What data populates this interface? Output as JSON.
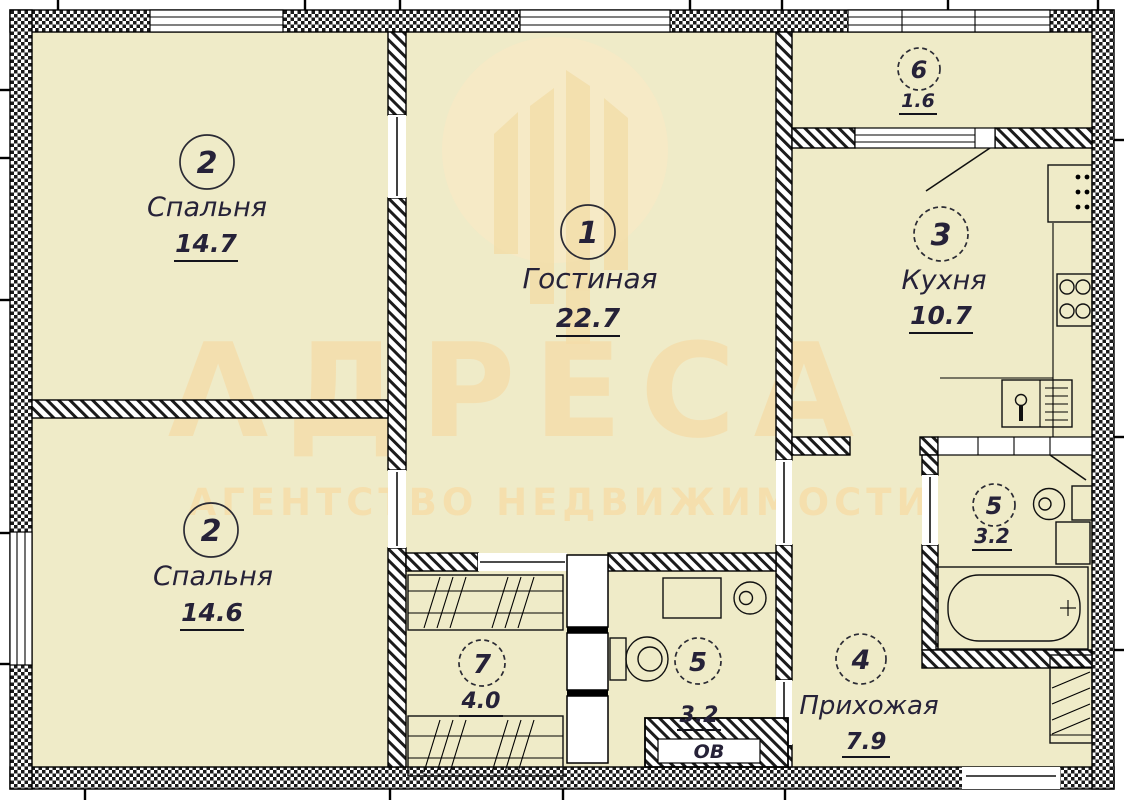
{
  "plan": {
    "watermark": {
      "brand": "АДРЕСА",
      "tagline": "АГЕНТСТВО НЕДВИЖИМОСТИ",
      "logo": "building-in-circle-logo"
    },
    "rooms": {
      "living": {
        "number": "1",
        "name": "Гостиная",
        "area": "22.7"
      },
      "bedroom_top": {
        "number": "2",
        "name": "Спальня",
        "area": "14.7"
      },
      "bedroom_bottom": {
        "number": "2",
        "name": "Спальня",
        "area": "14.6"
      },
      "kitchen": {
        "number": "3",
        "name": "Кухня",
        "area": "10.7"
      },
      "hallway": {
        "number": "4",
        "name": "Прихожая",
        "area": "7.9"
      },
      "bathroom": {
        "number": "5",
        "area": "3.2"
      },
      "wc": {
        "number": "5",
        "area": "3.2"
      },
      "balcony": {
        "number": "6",
        "area": "1.6"
      },
      "wardrobe": {
        "number": "7",
        "area": "4.0"
      }
    },
    "labels": {
      "duct": "ОВ"
    },
    "fixtures": [
      "bathtub",
      "round-sink",
      "washing-machine",
      "toilet",
      "kitchen-sink",
      "stove",
      "fridge",
      "wardrobe-shelves",
      "closet-shelves",
      "ventilation-shaft"
    ],
    "colors": {
      "room_fill": "#efebc8",
      "wall": "#111111",
      "label_text": "#262238",
      "watermark": "#f7d9a2"
    }
  }
}
